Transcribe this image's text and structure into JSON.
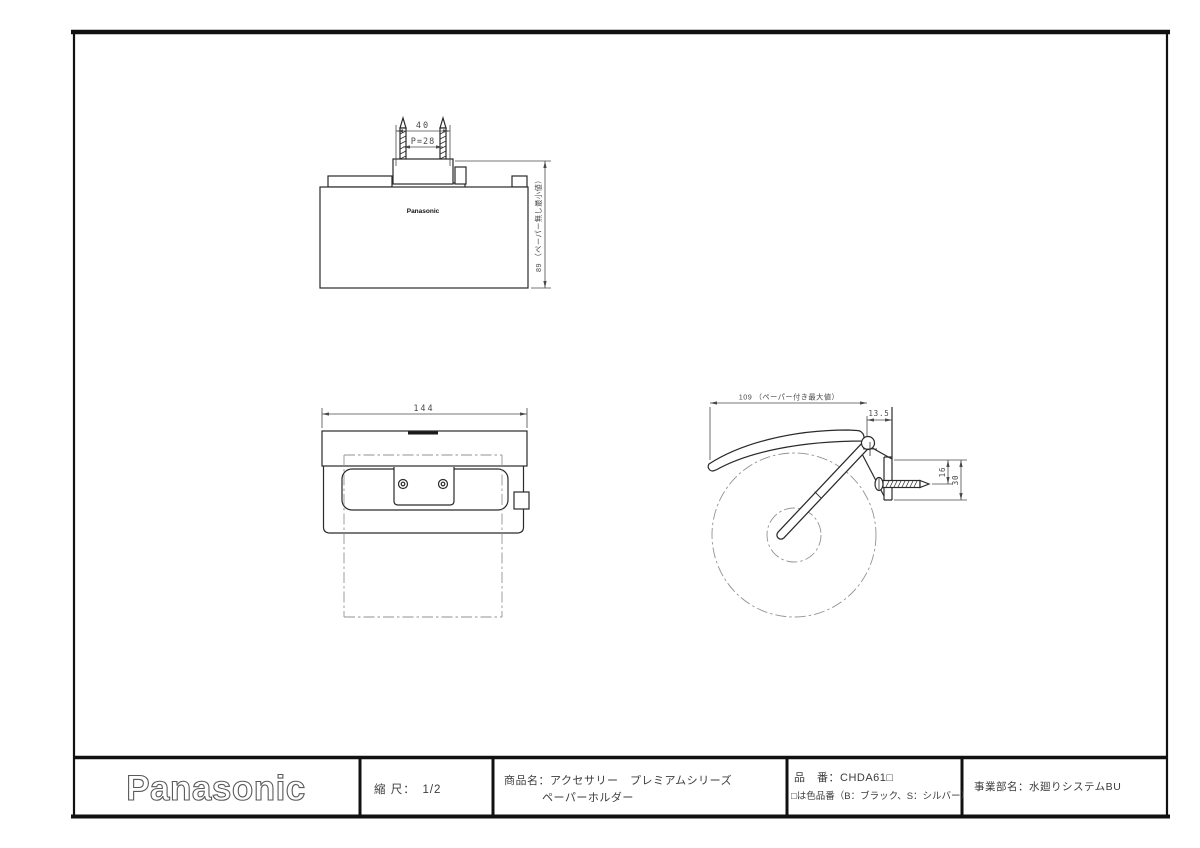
{
  "title_block": {
    "logo": "Panasonic",
    "scale": "縮 尺：　1/2",
    "product_line1": "商品名：アクセサリー　プレミアムシリーズ",
    "product_line2": "ペーパーホルダー",
    "part_number": "品　番：CHDA61□",
    "part_number_note": "□は色品番（B：ブラック、S：シルバー）",
    "division": "事業部名：水廻りシステムBU"
  },
  "plan_view": {
    "brand_mark": "Panasonic",
    "dim_screw_span": "40",
    "dim_screw_pitch": "P=28",
    "dim_depth": "89 （ペーパー無し最小値）"
  },
  "front_view": {
    "dim_width": "144"
  },
  "side_view": {
    "dim_depth_max": "109 （ペーパー付き最大値）",
    "dim_hinge_offset": "13.5",
    "dim_screw_height": "16",
    "dim_plate_height": "30"
  },
  "colors": {
    "line": "#2a2a2a",
    "dimension": "#4a4a4a",
    "phantom": "#929292",
    "frame": "#111111"
  }
}
